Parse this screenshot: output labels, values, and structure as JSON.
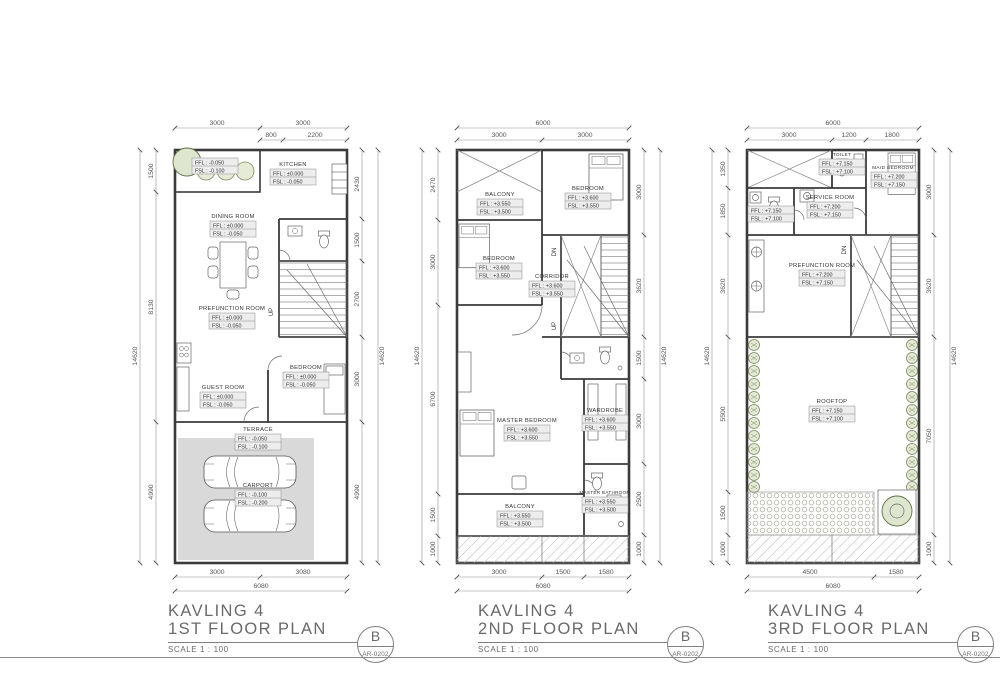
{
  "sheet": {
    "titles": [
      {
        "project": "KAVLING 4",
        "name": "1ST FLOOR PLAN",
        "scale": "SCALE 1 : 100",
        "rev": "B",
        "no": "AR-0202"
      },
      {
        "project": "KAVLING 4",
        "name": "2ND FLOOR PLAN",
        "scale": "SCALE 1 : 100",
        "rev": "B",
        "no": "AR-0202"
      },
      {
        "project": "KAVLING 4",
        "name": "3RD FLOOR PLAN",
        "scale": "SCALE 1 : 100",
        "rev": "B",
        "no": "AR-0202"
      }
    ]
  },
  "colors": {
    "walls": "#3a3a3a",
    "dimension_text": "#555555",
    "label_fill": "#ededed",
    "carport_fill": "#d9d9d9",
    "greenery": "#7b8a5f"
  },
  "p1": {
    "dims": {
      "top": [
        "3000",
        "3000"
      ],
      "top_sub": [
        "800",
        "2200"
      ],
      "left": [
        "1500",
        "8130",
        "4990"
      ],
      "left_overall": "14620",
      "right": [
        "2430",
        "1500",
        "2700",
        "3000",
        "4990"
      ],
      "right_overall": "14620",
      "bottom": [
        "3000",
        "3080"
      ],
      "bottom_overall": "6080"
    },
    "rooms": {
      "planter": {
        "ffl": "FFL : -0.050",
        "fsl": "FSL : -0.100"
      },
      "kitchen": {
        "name": "KITCHEN",
        "ffl": "FFL : ±0.000",
        "fsl": "FSL : -0.050"
      },
      "dining": {
        "name": "DINING ROOM",
        "ffl": "FFL : ±0.000",
        "fsl": "FSL : -0.050"
      },
      "prefunction": {
        "name": "PREFUNCTION ROOM",
        "ffl": "FFL : ±0.000",
        "fsl": "FSL : -0.050"
      },
      "guest": {
        "name": "GUEST ROOM",
        "ffl": "FFL : ±0.000",
        "fsl": "FSL : -0.050"
      },
      "bedroom": {
        "name": "BEDROOM",
        "ffl": "FFL : ±0.000",
        "fsl": "FSL : -0.050"
      },
      "terrace": {
        "name": "TERRACE",
        "ffl": "FFL : -0.050",
        "fsl": "FSL : -0.100"
      },
      "carport": {
        "name": "CARPORT",
        "ffl": "FFL : -0.100",
        "fsl": "FSL : -0.200"
      }
    },
    "stairs": {
      "up": "UP"
    }
  },
  "p2": {
    "dims": {
      "top_overall": "6000",
      "top": [
        "3000",
        "3000"
      ],
      "left": [
        "2470",
        "3000",
        "6700",
        "1500",
        "1000"
      ],
      "left_overall": "14620",
      "right": [
        "3000",
        "3620",
        "1500",
        "3000",
        "2500",
        "1000"
      ],
      "right_overall": "14620",
      "bottom": [
        "3000",
        "1500",
        "1580"
      ],
      "bottom_overall": "6080"
    },
    "rooms": {
      "balcony_top": {
        "name": "BALCONY",
        "ffl": "FFL : +3.550",
        "fsl": "FSL : +3.500"
      },
      "bedroom_front": {
        "name": "BEDROOM",
        "ffl": "FFL : +3.600",
        "fsl": "FSL : +3.550"
      },
      "bedroom_middle": {
        "name": "BEDROOM",
        "ffl": "FFL : +3.600",
        "fsl": "FSL : +3.550"
      },
      "corridor": {
        "name": "CORRIDOR",
        "ffl": "FFL : +3.600",
        "fsl": "FSL : +3.550"
      },
      "master_bedroom": {
        "name": "MASTER BEDROOM",
        "ffl": "FFL : +3.600",
        "fsl": "FSL : +3.550"
      },
      "wardrobe": {
        "name": "WARDROBE",
        "ffl": "FFL : +3.600",
        "fsl": "FSL : +3.550"
      },
      "master_bathroom": {
        "name": "MASTER BATHROOM",
        "ffl": "FFL : +3.550",
        "fsl": "FSL : +3.500"
      },
      "balcony_rear": {
        "name": "BALCONY",
        "ffl": "FFL : +3.550",
        "fsl": "FSL : +3.500"
      }
    },
    "stairs": {
      "dn": "DN",
      "up": "UP"
    }
  },
  "p3": {
    "dims": {
      "top_overall": "6000",
      "top": [
        "3000",
        "1200",
        "1800"
      ],
      "left": [
        "1350",
        "1850",
        "3620",
        "5500",
        "1500",
        "1000"
      ],
      "left_overall": "14620",
      "right": [
        "3000",
        "3620",
        "7050",
        "1000"
      ],
      "right_overall": "14620",
      "bottom": [
        "4500",
        "1580"
      ],
      "bottom_overall": "6080"
    },
    "rooms": {
      "toilet_front": {
        "name": "TOILET",
        "ffl": "FFL : +7.150",
        "fsl": "FSL : +7.100"
      },
      "maid_bedroom": {
        "name": "MAID BEDROOM",
        "ffl": "FFL : +7.200",
        "fsl": "FSL : +7.150"
      },
      "service": {
        "name": "SERVICE ROOM",
        "ffl": "FFL : +7.200",
        "fsl": "FSL : +7.150"
      },
      "toilet_side": {
        "ffl": "FFL : +7.150",
        "fsl": "FSL : +7.100"
      },
      "prefunction": {
        "name": "PREFUNCTION ROOM",
        "ffl": "FFL : +7.200",
        "fsl": "FSL : +7.150"
      },
      "rooftop": {
        "name": "ROOFTOP",
        "ffl": "FFL : +7.150",
        "fsl": "FSL : +7.100"
      }
    },
    "stairs": {
      "dn": "DN"
    }
  }
}
